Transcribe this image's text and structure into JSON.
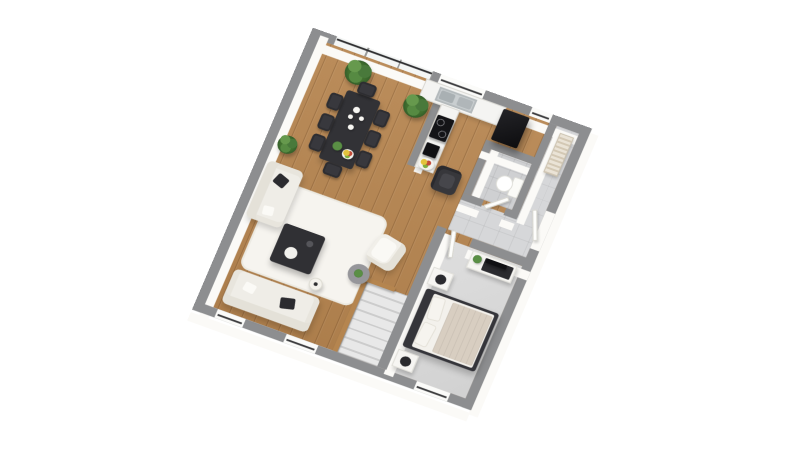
{
  "scene": {
    "description": "3d-isometric-floor-plan",
    "background": "#ffffff"
  },
  "palette": {
    "wall_top": "#8d8e90",
    "wall_face": "#fbfaf7",
    "wood_floor": "#b68550",
    "tile_floor": "#d6d7d9",
    "bathroom_tile": "#cfd0d2",
    "bedroom_carpet": "#dadada",
    "furniture_dark": "#323236",
    "sofa_white": "#efede7",
    "plant_green": "#4a7c3a",
    "stair_wood": "#b5854f",
    "radiator_beige": "#e0d7c6"
  },
  "view": {
    "rx": 23.4,
    "rz": 21.5,
    "left": 242,
    "top": 54,
    "width": 300,
    "height": 330
  },
  "rooms": [
    {
      "name": "living-room",
      "floor": "wood"
    },
    {
      "name": "dining-area",
      "floor": "wood"
    },
    {
      "name": "kitchen",
      "floor": "wood"
    },
    {
      "name": "bathroom",
      "floor": "gray-tile"
    },
    {
      "name": "entry-hallway",
      "floor": "gray-tile"
    },
    {
      "name": "bedroom",
      "floor": "gray-carpet"
    },
    {
      "name": "staircase",
      "floor": "gray-carpet"
    }
  ],
  "plan": {
    "floors": [
      {
        "n": "floor-living-dining-kitchen",
        "k": "f-wood",
        "x": 10,
        "y": 10,
        "w": 280,
        "h": 310
      },
      {
        "n": "floor-hallway",
        "k": "f-tile",
        "x": 266,
        "y": 10,
        "w": 24,
        "h": 145
      },
      {
        "n": "floor-entry",
        "k": "f-tile",
        "x": 206,
        "y": 118,
        "w": 84,
        "h": 37
      },
      {
        "n": "floor-bathroom",
        "k": "f-tile2",
        "x": 214,
        "y": 58,
        "w": 44,
        "h": 54
      },
      {
        "n": "floor-bedroom",
        "k": "f-carpet",
        "x": 205,
        "y": 165,
        "w": 85,
        "h": 155
      }
    ],
    "rug": [
      {
        "n": "living-room-rug",
        "k": "k-rug",
        "x": 28,
        "y": 168,
        "w": 118,
        "h": 100
      }
    ],
    "stairs": [
      {
        "n": "staircase",
        "k": "k-stairs",
        "x": 152,
        "y": 237,
        "w": 48,
        "h": 83
      },
      {
        "n": "stair-railing",
        "k": "k-rail",
        "x": 147,
        "y": 233,
        "w": 5,
        "h": 87
      },
      {
        "n": "stair-railing-top",
        "k": "k-rail",
        "x": 147,
        "y": 233,
        "w": 34,
        "h": 5
      }
    ],
    "walls": [
      {
        "n": "wall-outer-top",
        "k": "wall wall-h",
        "x": 0,
        "y": 0,
        "w": 300,
        "h": 10
      },
      {
        "n": "wall-outer-left",
        "k": "wall wall-v",
        "x": 0,
        "y": 0,
        "w": 10,
        "h": 330
      },
      {
        "n": "wall-outer-bottom",
        "k": "wall wall-h",
        "x": 0,
        "y": 320,
        "w": 300,
        "h": 10
      },
      {
        "n": "wall-outer-right",
        "k": "wall wall-v",
        "x": 290,
        "y": 0,
        "w": 10,
        "h": 330
      },
      {
        "n": "wall-kitchen-peninsula",
        "k": "wall wall-v",
        "x": 142,
        "y": 30,
        "w": 8,
        "h": 74
      },
      {
        "n": "wall-bathroom-left",
        "k": "wall wall-v",
        "x": 206,
        "y": 50,
        "w": 8,
        "h": 62
      },
      {
        "n": "wall-bathroom-top",
        "k": "wall wall-h",
        "x": 206,
        "y": 50,
        "w": 60,
        "h": 8
      },
      {
        "n": "wall-hall-divider",
        "k": "wall wall-v",
        "x": 258,
        "y": 10,
        "w": 8,
        "h": 108
      },
      {
        "n": "wall-bathroom-bottom-a",
        "k": "wall wall-h",
        "x": 206,
        "y": 112,
        "w": 22,
        "h": 8
      },
      {
        "n": "wall-bathroom-bottom-b",
        "k": "wall wall-h",
        "x": 252,
        "y": 112,
        "w": 14,
        "h": 8
      },
      {
        "n": "wall-bedroom-top-a",
        "k": "wall wall-h",
        "x": 195,
        "y": 155,
        "w": 8,
        "h": 10
      },
      {
        "n": "wall-bedroom-top-b",
        "k": "wall wall-h",
        "x": 233,
        "y": 155,
        "w": 67,
        "h": 10
      },
      {
        "n": "wall-bedroom-left",
        "k": "wall wall-v",
        "x": 195,
        "y": 155,
        "w": 10,
        "h": 165
      }
    ],
    "windows": [
      {
        "n": "glazed-bay-window",
        "k": "k-glazing",
        "x": 26,
        "y": 0,
        "w": 104,
        "h": 10
      },
      {
        "n": "kitchen-window",
        "k": "k-window w-h",
        "x": 138,
        "y": 0,
        "w": 48,
        "h": 10
      },
      {
        "n": "hallway-window",
        "k": "k-window w-h",
        "x": 236,
        "y": 0,
        "w": 22,
        "h": 10
      },
      {
        "n": "living-window-1",
        "k": "k-window w-h",
        "x": 24,
        "y": 320,
        "w": 30,
        "h": 10
      },
      {
        "n": "living-window-2",
        "k": "k-window w-h",
        "x": 98,
        "y": 320,
        "w": 34,
        "h": 10
      },
      {
        "n": "bedroom-window",
        "k": "k-window w-h",
        "x": 238,
        "y": 320,
        "w": 36,
        "h": 10
      },
      {
        "n": "entry-door-opening",
        "k": "k-opening",
        "x": 290,
        "y": 100,
        "w": 10,
        "h": 44
      }
    ],
    "doors": [
      {
        "n": "entry-door-leaf",
        "k": "k-door-leaf",
        "x": 283,
        "y": 102,
        "w": 5,
        "h": 34,
        "r": -22
      },
      {
        "n": "bathroom-door-leaf",
        "k": "k-door-leaf",
        "x": 228,
        "y": 108,
        "w": 26,
        "h": 5,
        "r": -42
      },
      {
        "n": "bedroom-door-leaf",
        "k": "k-door-leaf",
        "x": 201,
        "y": 166,
        "w": 30,
        "h": 5,
        "r": 76
      }
    ],
    "furniture": [
      {
        "n": "kitchen-counter",
        "k": "k-counter",
        "x": 126,
        "y": 10,
        "w": 86,
        "h": 22
      },
      {
        "n": "kitchen-sink",
        "k": "k-sink",
        "x": 142,
        "y": 13,
        "w": 40,
        "h": 16
      },
      {
        "n": "kitchen-counter-leg",
        "k": "k-counter",
        "x": 150,
        "y": 30,
        "w": 20,
        "h": 74
      },
      {
        "n": "induction-hob",
        "k": "k-hob",
        "x": 151,
        "y": 42,
        "w": 18,
        "h": 26
      },
      {
        "n": "coffee-machine",
        "k": "k-appliance",
        "x": 152,
        "y": 74,
        "w": 14,
        "h": 14
      },
      {
        "n": "fruit-plate",
        "k": "k-fruit",
        "x": 151,
        "y": 90,
        "w": 17,
        "h": 13
      },
      {
        "n": "fridge",
        "k": "k-fridge",
        "x": 210,
        "y": 12,
        "w": 28,
        "h": 36
      },
      {
        "n": "kitchen-armchair-dark",
        "k": "k-armchair-dark",
        "x": 172,
        "y": 92,
        "w": 26,
        "h": 28
      },
      {
        "n": "plant-kitchen",
        "k": "k-plant",
        "x": 112,
        "y": 28,
        "w": 30,
        "h": 28
      },
      {
        "n": "plant-dining",
        "k": "k-plant",
        "x": 44,
        "y": 14,
        "w": 32,
        "h": 30
      },
      {
        "n": "dining-table",
        "k": "k-table-dark",
        "x": 57,
        "y": 50,
        "w": 36,
        "h": 80
      },
      {
        "n": "dining-chair",
        "k": "k-chair",
        "x": 43,
        "y": 58,
        "w": 14,
        "h": 18
      },
      {
        "n": "dining-chair",
        "k": "k-chair",
        "x": 43,
        "y": 82,
        "w": 14,
        "h": 18
      },
      {
        "n": "dining-chair",
        "k": "k-chair",
        "x": 43,
        "y": 106,
        "w": 14,
        "h": 18
      },
      {
        "n": "dining-chair",
        "k": "k-chair",
        "x": 93,
        "y": 58,
        "w": 14,
        "h": 18
      },
      {
        "n": "dining-chair",
        "k": "k-chair",
        "x": 93,
        "y": 82,
        "w": 14,
        "h": 18
      },
      {
        "n": "dining-chair",
        "k": "k-chair",
        "x": 93,
        "y": 106,
        "w": 14,
        "h": 18
      },
      {
        "n": "dining-chair",
        "k": "k-chair",
        "x": 66,
        "y": 36,
        "w": 18,
        "h": 14
      },
      {
        "n": "dining-chair",
        "k": "k-chair",
        "x": 66,
        "y": 130,
        "w": 18,
        "h": 14
      },
      {
        "n": "sofa-two-seat",
        "k": "k-sofa-v",
        "x": 12,
        "y": 150,
        "w": 38,
        "h": 66
      },
      {
        "n": "sofa-three-seat",
        "k": "k-sofa-h",
        "x": 24,
        "y": 272,
        "w": 92,
        "h": 40
      },
      {
        "n": "coffee-table",
        "k": "k-coffee-table",
        "x": 52,
        "y": 208,
        "w": 44,
        "h": 44
      },
      {
        "n": "floor-lamp",
        "k": "k-floor-lamp",
        "x": 98,
        "y": 252,
        "w": 14,
        "h": 14
      },
      {
        "n": "plant-living",
        "k": "k-plant",
        "x": 12,
        "y": 116,
        "w": 22,
        "h": 24
      },
      {
        "n": "armchair-white",
        "k": "k-armchair",
        "x": 142,
        "y": 184,
        "w": 32,
        "h": 34,
        "r": 12
      },
      {
        "n": "side-table-plant",
        "k": "k-side-table",
        "x": 130,
        "y": 222,
        "w": 22,
        "h": 22
      },
      {
        "n": "toilet",
        "k": "k-toilet",
        "x": 232,
        "y": 76,
        "w": 26,
        "h": 22
      },
      {
        "n": "radiator",
        "k": "k-radiator",
        "x": 272,
        "y": 16,
        "w": 15,
        "h": 46
      },
      {
        "n": "bedroom-dresser",
        "k": "k-dresser",
        "x": 238,
        "y": 167,
        "w": 48,
        "h": 20
      },
      {
        "n": "tv-on-dresser",
        "k": "k-appliance",
        "x": 254,
        "y": 170,
        "w": 22,
        "h": 5
      },
      {
        "n": "dresser-plant",
        "k": "k-dot-green",
        "x": 241,
        "y": 170,
        "w": 9,
        "h": 9
      },
      {
        "n": "double-bed",
        "k": "k-bed",
        "x": 210,
        "y": 222,
        "w": 78,
        "h": 68
      },
      {
        "n": "bed-pillow",
        "k": "k-pillow",
        "x": 220,
        "y": 227,
        "w": 14,
        "h": 26,
        "r": -6
      },
      {
        "n": "bed-pillow",
        "k": "k-pillow",
        "x": 220,
        "y": 257,
        "w": 14,
        "h": 26,
        "r": 5
      },
      {
        "n": "nightstand",
        "k": "k-nightstand",
        "x": 208,
        "y": 198,
        "w": 22,
        "h": 20
      },
      {
        "n": "nightstand",
        "k": "k-nightstand",
        "x": 208,
        "y": 294,
        "w": 22,
        "h": 20
      }
    ],
    "decor": [
      {
        "n": "teapot",
        "k": "k-dot-white",
        "x": 70,
        "y": 64,
        "w": 7,
        "h": 7
      },
      {
        "n": "cup",
        "k": "k-dot-white",
        "x": 79,
        "y": 72,
        "w": 5,
        "h": 5
      },
      {
        "n": "cup",
        "k": "k-dot-white",
        "x": 68,
        "y": 74,
        "w": 5,
        "h": 5
      },
      {
        "n": "vase",
        "k": "k-dot-white",
        "x": 72,
        "y": 84,
        "w": 6,
        "h": 6
      },
      {
        "n": "salad-bowl",
        "k": "k-dot-green",
        "x": 65,
        "y": 106,
        "w": 10,
        "h": 10
      },
      {
        "n": "fruit-bowl-table",
        "k": "k-fruit",
        "x": 77,
        "y": 110,
        "w": 12,
        "h": 11
      }
    ]
  }
}
